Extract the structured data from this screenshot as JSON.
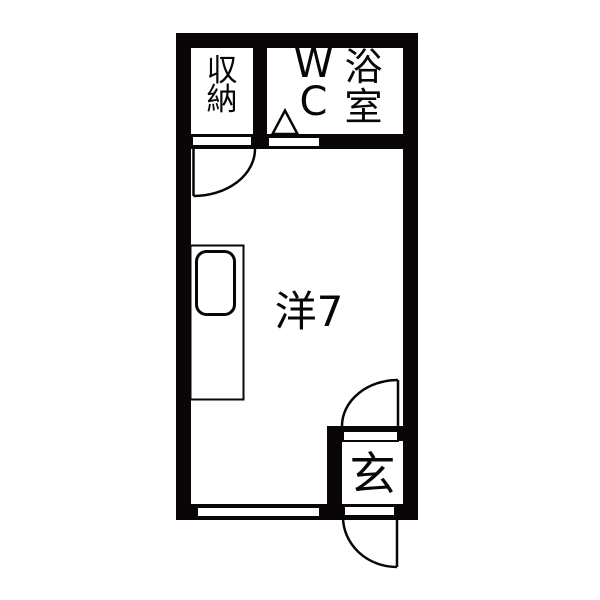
{
  "plan_title": "studio-apartment-floorplan",
  "colors": {
    "wall": "#0a0606",
    "floor": "#ffffff"
  },
  "rooms": {
    "closet": {
      "label": "収納"
    },
    "wc": {
      "label": "WC"
    },
    "bath": {
      "label": "浴室"
    },
    "living": {
      "label": "洋7"
    },
    "entrance": {
      "label": "玄"
    }
  }
}
